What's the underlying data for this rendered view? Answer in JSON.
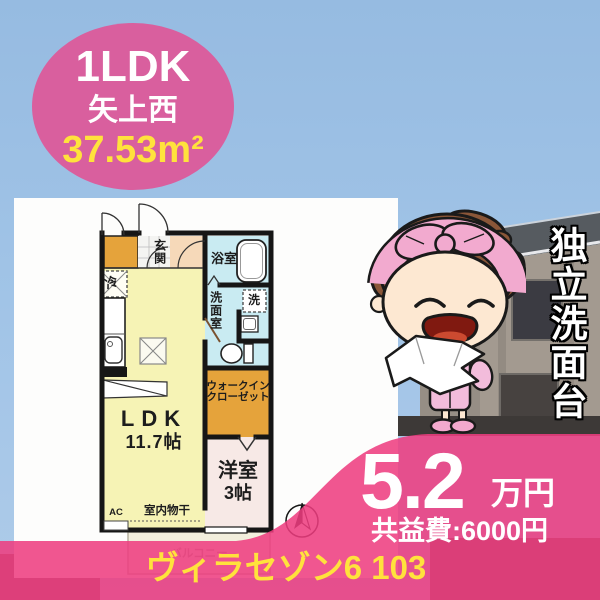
{
  "badge": {
    "layout": "1LDK",
    "area_name": "矢上西",
    "floor_area": "37.53m²"
  },
  "plan": {
    "genkan": "玄関",
    "bathroom": "浴室",
    "washroom": "洗面室",
    "washer_symbol": "洗",
    "fridge_symbol": "冷",
    "ldk_label": "LDK",
    "ldk_size": "11.7帖",
    "wic_line1": "ウォークイン",
    "wic_line2": "クローゼット",
    "western_label": "洋室",
    "western_size": "3帖",
    "indoor_drying": "室内物干",
    "ac_label": "AC",
    "balcony": "バルコニー"
  },
  "feature_vertical_text": "独立洗面台",
  "price": {
    "rent": "5.2",
    "unit": "万円",
    "common_fee": "共益費:6000円"
  },
  "property_name": "ヴィラセゾン6 103",
  "colors": {
    "badge_pink": "#d95f9e",
    "overlay_pink": "#ee3d80",
    "accent_yellow": "#ffe23c",
    "ldk_yellow": "#f6f3b5",
    "wet_cyan": "#c9ebf2",
    "closet_orange": "#e5a33b",
    "western_pink": "#f7e9e6",
    "hall_peach": "#f6d9b9",
    "sky_blue": "#9fc2e4",
    "mascot_pink": "#f2aacf",
    "mascot_hair_brown": "#8a5638"
  }
}
